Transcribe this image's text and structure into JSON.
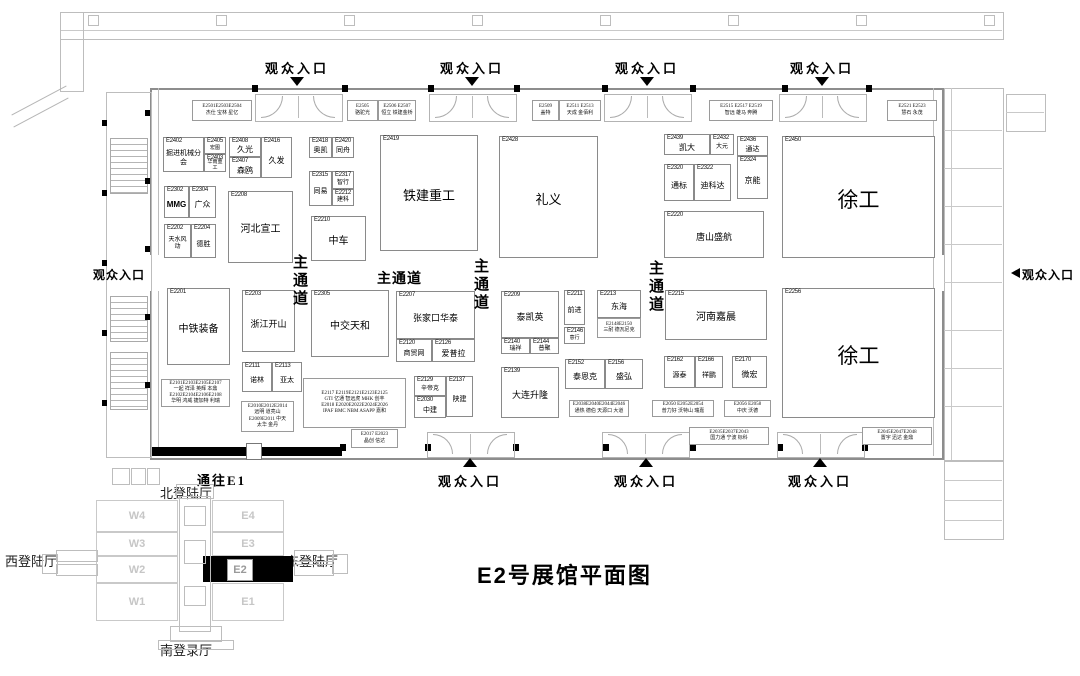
{
  "title": "E2号展馆平面图",
  "labels": {
    "entrance": "观众入口",
    "to_e1": "通往E1",
    "main_aisle": "主通道"
  },
  "minimap": {
    "north": "北登陆厅",
    "south": "南登录厅",
    "west": "西登陆厅",
    "east": "东登陆厅",
    "west_halls": [
      "W4",
      "W3",
      "W2",
      "W1"
    ],
    "east_halls": [
      "E4",
      "E3",
      "E2",
      "E1"
    ],
    "highlighted": "E2"
  },
  "booths": [
    {
      "id": "E2402",
      "name": "掘进机械分会",
      "x": 163,
      "y": 137,
      "w": 41,
      "h": 35,
      "nfs": 7
    },
    {
      "id": "E2405",
      "name": "宏图",
      "x": 204,
      "y": 137,
      "w": 22,
      "h": 17,
      "nfs": 5
    },
    {
      "id": "E2403",
      "name": "华南重工",
      "x": 204,
      "y": 154,
      "w": 22,
      "h": 18,
      "nfs": 5
    },
    {
      "id": "E2408",
      "name": "久光",
      "x": 229,
      "y": 137,
      "w": 32,
      "h": 20,
      "nfs": 8
    },
    {
      "id": "E2407",
      "name": "森鸥",
      "x": 229,
      "y": 157,
      "w": 32,
      "h": 21,
      "nfs": 8
    },
    {
      "id": "E2416",
      "name": "久发",
      "x": 261,
      "y": 137,
      "w": 31,
      "h": 41,
      "nfs": 8
    },
    {
      "id": "E2418",
      "name": "奥凯",
      "x": 309,
      "y": 137,
      "w": 23,
      "h": 21,
      "nfs": 7
    },
    {
      "id": "E2420",
      "name": "同舟",
      "x": 332,
      "y": 137,
      "w": 22,
      "h": 21,
      "nfs": 7
    },
    {
      "id": "E2315",
      "name": "同易",
      "x": 309,
      "y": 171,
      "w": 23,
      "h": 35,
      "nfs": 7
    },
    {
      "id": "E2317",
      "name": "智行",
      "x": 332,
      "y": 171,
      "w": 22,
      "h": 18,
      "nfs": 6
    },
    {
      "id": "E2212",
      "name": "建科",
      "x": 332,
      "y": 189,
      "w": 22,
      "h": 17,
      "nfs": 6
    },
    {
      "id": "E2419",
      "name": "铁建重工",
      "x": 380,
      "y": 135,
      "w": 98,
      "h": 116,
      "nfs": 13
    },
    {
      "id": "E2302",
      "name": "MMG",
      "x": 164,
      "y": 186,
      "w": 25,
      "h": 32,
      "nfs": 8,
      "bold": true
    },
    {
      "id": "E2304",
      "name": "广众",
      "x": 189,
      "y": 186,
      "w": 27,
      "h": 32,
      "nfs": 8
    },
    {
      "id": "E2208",
      "name": "河北宣工",
      "x": 228,
      "y": 191,
      "w": 65,
      "h": 72,
      "nfs": 10
    },
    {
      "id": "E2210",
      "name": "中车",
      "x": 311,
      "y": 216,
      "w": 55,
      "h": 45,
      "nfs": 10
    },
    {
      "id": "E2202",
      "name": "天水风动",
      "x": 164,
      "y": 224,
      "w": 27,
      "h": 34,
      "nfs": 6
    },
    {
      "id": "E2204",
      "name": "德胜",
      "x": 191,
      "y": 224,
      "w": 25,
      "h": 34,
      "nfs": 7
    },
    {
      "id": "E2428",
      "name": "礼义",
      "x": 499,
      "y": 136,
      "w": 99,
      "h": 122,
      "nfs": 13
    },
    {
      "id": "E2439",
      "name": "凯大",
      "x": 664,
      "y": 134,
      "w": 46,
      "h": 21,
      "nfs": 8
    },
    {
      "id": "E2432",
      "name": "大元",
      "x": 710,
      "y": 134,
      "w": 24,
      "h": 21,
      "nfs": 6
    },
    {
      "id": "E2436",
      "name": "通达",
      "x": 737,
      "y": 136,
      "w": 31,
      "h": 20,
      "nfs": 7
    },
    {
      "id": "E2324",
      "name": "京能",
      "x": 737,
      "y": 156,
      "w": 31,
      "h": 43,
      "nfs": 8
    },
    {
      "id": "E2320",
      "name": "通标",
      "x": 664,
      "y": 164,
      "w": 30,
      "h": 37,
      "nfs": 8
    },
    {
      "id": "E2322",
      "name": "迪科达",
      "x": 694,
      "y": 164,
      "w": 37,
      "h": 37,
      "nfs": 8
    },
    {
      "id": "E2220",
      "name": "唐山盛航",
      "x": 664,
      "y": 211,
      "w": 100,
      "h": 47,
      "nfs": 9
    },
    {
      "id": "E2450",
      "name": "徐工",
      "x": 782,
      "y": 136,
      "w": 153,
      "h": 122,
      "nfs": 21
    },
    {
      "id": "E2201",
      "name": "中铁装备",
      "x": 167,
      "y": 288,
      "w": 63,
      "h": 77,
      "nfs": 10
    },
    {
      "id": "E2203",
      "name": "浙江开山",
      "x": 242,
      "y": 290,
      "w": 53,
      "h": 62,
      "nfs": 9
    },
    {
      "id": "E2305",
      "name": "中交天和",
      "x": 311,
      "y": 290,
      "w": 78,
      "h": 67,
      "nfs": 10
    },
    {
      "id": "E2111",
      "name": "诺林",
      "x": 242,
      "y": 362,
      "w": 30,
      "h": 30,
      "nfs": 7
    },
    {
      "id": "E2113",
      "name": "亚太",
      "x": 272,
      "y": 362,
      "w": 30,
      "h": 30,
      "nfs": 7
    },
    {
      "id": "E2207",
      "name": "张家口华泰",
      "x": 396,
      "y": 291,
      "w": 79,
      "h": 48,
      "nfs": 9
    },
    {
      "id": "E2120",
      "name": "商贸网",
      "x": 396,
      "y": 339,
      "w": 36,
      "h": 23,
      "nfs": 7
    },
    {
      "id": "E2126",
      "name": "爱普拉",
      "x": 432,
      "y": 339,
      "w": 43,
      "h": 23,
      "nfs": 8
    },
    {
      "id": "E2209",
      "name": "泰凯英",
      "x": 501,
      "y": 291,
      "w": 58,
      "h": 47,
      "nfs": 9
    },
    {
      "id": "E2140",
      "name": "瑞祥",
      "x": 501,
      "y": 338,
      "w": 29,
      "h": 16,
      "nfs": 6
    },
    {
      "id": "E2144",
      "name": "普聚",
      "x": 530,
      "y": 338,
      "w": 29,
      "h": 16,
      "nfs": 6
    },
    {
      "id": "E2139",
      "name": "大连升隆",
      "x": 501,
      "y": 367,
      "w": 58,
      "h": 51,
      "nfs": 9
    },
    {
      "id": "E2129",
      "name": "辛帝克",
      "x": 414,
      "y": 376,
      "w": 32,
      "h": 20,
      "nfs": 6
    },
    {
      "id": "E2030",
      "name": "中建",
      "x": 414,
      "y": 396,
      "w": 32,
      "h": 22,
      "nfs": 7
    },
    {
      "id": "E2137",
      "name": "陕建",
      "x": 446,
      "y": 376,
      "w": 27,
      "h": 41,
      "nfs": 7
    },
    {
      "id": "E2211",
      "name": "前进",
      "x": 564,
      "y": 290,
      "w": 21,
      "h": 35,
      "nfs": 7
    },
    {
      "id": "E2146",
      "name": "意行",
      "x": 564,
      "y": 327,
      "w": 21,
      "h": 17,
      "nfs": 5
    },
    {
      "id": "E2213",
      "name": "东海",
      "x": 597,
      "y": 290,
      "w": 44,
      "h": 28,
      "nfs": 8
    },
    {
      "id": "E2215",
      "name": "河南嘉晨",
      "x": 665,
      "y": 290,
      "w": 102,
      "h": 50,
      "nfs": 10
    },
    {
      "id": "E2152",
      "name": "泰恩克",
      "x": 565,
      "y": 359,
      "w": 40,
      "h": 30,
      "nfs": 8
    },
    {
      "id": "E2156",
      "name": "盛弘",
      "x": 605,
      "y": 359,
      "w": 38,
      "h": 30,
      "nfs": 8
    },
    {
      "id": "E2162",
      "name": "源泰",
      "x": 664,
      "y": 356,
      "w": 31,
      "h": 32,
      "nfs": 7
    },
    {
      "id": "E2166",
      "name": "祥鹏",
      "x": 695,
      "y": 356,
      "w": 28,
      "h": 32,
      "nfs": 7
    },
    {
      "id": "E2170",
      "name": "微宏",
      "x": 732,
      "y": 356,
      "w": 35,
      "h": 32,
      "nfs": 8
    },
    {
      "id": "E2256",
      "name": "徐工",
      "x": 782,
      "y": 288,
      "w": 153,
      "h": 130,
      "nfs": 21
    }
  ],
  "strips": [
    {
      "x": 192,
      "y": 100,
      "w": 60,
      "h": 21,
      "lines": [
        "E2501E2503E2504",
        "杰仕 宝林 星亿"
      ]
    },
    {
      "x": 347,
      "y": 100,
      "w": 31,
      "h": 21,
      "lines": [
        "E2505",
        "骆驼光"
      ]
    },
    {
      "x": 378,
      "y": 100,
      "w": 38,
      "h": 21,
      "lines": [
        "E2506 E2507",
        "恒立 铁建金桥"
      ]
    },
    {
      "x": 532,
      "y": 100,
      "w": 27,
      "h": 21,
      "lines": [
        "E2509",
        "盖特"
      ]
    },
    {
      "x": 559,
      "y": 100,
      "w": 42,
      "h": 21,
      "lines": [
        "E2511 E2513",
        "天成 金佰利"
      ]
    },
    {
      "x": 709,
      "y": 100,
      "w": 64,
      "h": 21,
      "lines": [
        "E2515 E2517 E2519",
        "智远 雄马 奔腾"
      ]
    },
    {
      "x": 887,
      "y": 100,
      "w": 50,
      "h": 21,
      "lines": [
        "E2521 E2523",
        "慧石 永茂"
      ]
    },
    {
      "x": 597,
      "y": 318,
      "w": 44,
      "h": 20,
      "lines": [
        "E2148E2150",
        "三耐 德瓦尼克"
      ]
    },
    {
      "x": 161,
      "y": 379,
      "w": 69,
      "h": 28,
      "lines": [
        "E2101E2103E2105E2107",
        "一起 祥泽 英辉 本鼎",
        "E2102E2104E2106E2108",
        "华明 鸿威 捷加特 利瑞"
      ]
    },
    {
      "x": 241,
      "y": 401,
      "w": 53,
      "h": 31,
      "lines": [
        "E2010E2012E2014",
        "远明 道亮山",
        "E2009E2011 中天",
        "太华 金丹"
      ]
    },
    {
      "x": 303,
      "y": 378,
      "w": 103,
      "h": 50,
      "lines": [
        "E2117  E2119E2121E2123E2125",
        "GTI  亿通 智远虎 MHK 创丰",
        "E2018  E2020E2022E2024E2026",
        "IPAF  BMC NBM ASAPP 嘉和"
      ]
    },
    {
      "x": 351,
      "y": 429,
      "w": 47,
      "h": 19,
      "lines": [
        "E2017 E2023",
        "晶创 信达"
      ]
    },
    {
      "x": 569,
      "y": 400,
      "w": 60,
      "h": 17,
      "lines": [
        "E2038E2040E2044E2046",
        "通热 德伯 天源口 大道"
      ]
    },
    {
      "x": 652,
      "y": 400,
      "w": 62,
      "h": 17,
      "lines": [
        "E2050  E2052E2054",
        "普力好  沃特山 瑞嘉"
      ]
    },
    {
      "x": 724,
      "y": 400,
      "w": 47,
      "h": 17,
      "lines": [
        "E2056  E2058",
        "中庆  沃德"
      ]
    },
    {
      "x": 689,
      "y": 427,
      "w": 80,
      "h": 18,
      "lines": [
        "E2035E2037E2043",
        "国力通 宁波  标科"
      ]
    },
    {
      "x": 862,
      "y": 427,
      "w": 70,
      "h": 18,
      "lines": [
        "E2045E2047E2048",
        "置宇 迅达 金鼎"
      ]
    }
  ]
}
